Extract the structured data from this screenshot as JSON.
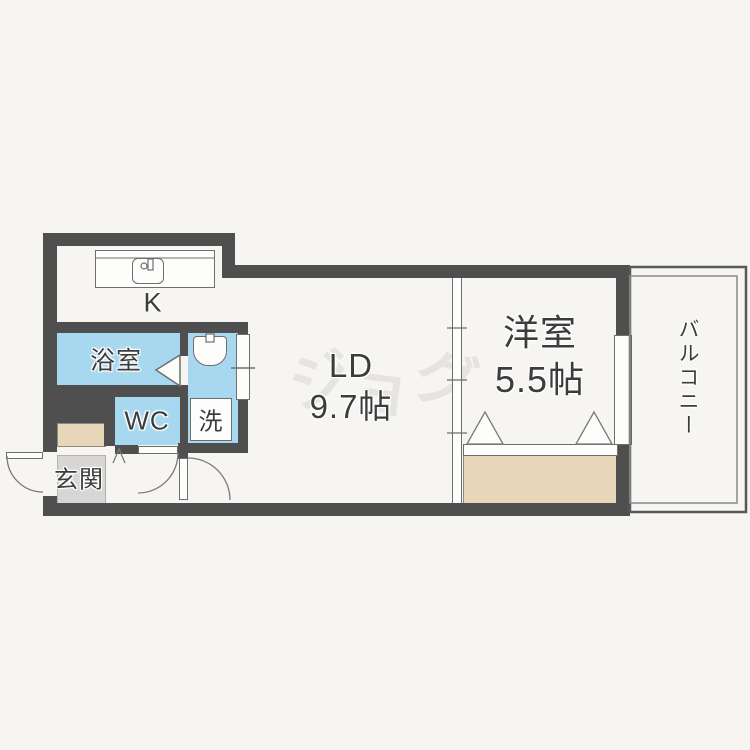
{
  "rooms": {
    "kitchen": {
      "label": "K"
    },
    "bathroom": {
      "label": "浴室"
    },
    "toilet": {
      "label": "WC"
    },
    "laundry": {
      "label": "洗"
    },
    "entrance": {
      "label": "玄関"
    },
    "living_dining": {
      "label": "LD",
      "size": "9.7帖"
    },
    "western_room": {
      "label": "洋室",
      "size": "5.5帖"
    },
    "balcony": {
      "label": "バルコニー"
    }
  },
  "watermark": {
    "char1": "ジ",
    "char2": "ョ",
    "char3": "グ"
  },
  "colors": {
    "wall": "#4f4f4f",
    "wet_area_fill": "#a8d8f0",
    "storage_fill": "#e7d6b8",
    "entrance_floor": "#d7d6d4",
    "background": "#f6f5f2",
    "outline": "#6e6e6e",
    "text": "#3c3c3c",
    "watermark": "#e6e4e0"
  }
}
